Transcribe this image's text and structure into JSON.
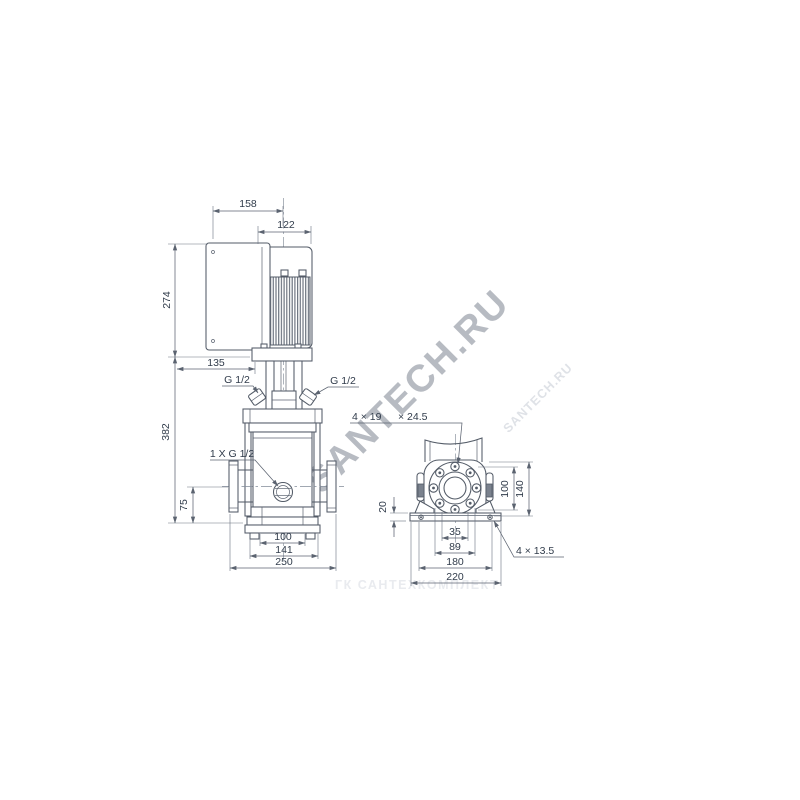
{
  "watermarks": {
    "main": "SANTECH.RU",
    "small": "SANTECH.RU",
    "bottom": "ГК САНТЕХКОМПЛЕКТ"
  },
  "front_view": {
    "dim_158": "158",
    "dim_122": "122",
    "dim_274": "274",
    "dim_135": "135",
    "port_left_label": "G 1/2",
    "port_right_label": "G 1/2",
    "dim_382": "382",
    "drain_label": "1 X G 1/2",
    "dim_75": "75",
    "dim_100": "100",
    "dim_141": "141",
    "dim_250": "250"
  },
  "side_view": {
    "flange_hole_count": "4 × 19",
    "flange_hole_depth": "× 24.5",
    "dim_100": "100",
    "dim_140": "140",
    "dim_20": "20",
    "dim_35": "35",
    "dim_89": "89",
    "dim_180": "180",
    "dim_220": "220",
    "base_hole_label": "4 × 13.5"
  },
  "colors": {
    "line": "#535b67",
    "text": "#313c4b",
    "watermark_main": "#b7bbc2",
    "watermark_faint": "#e9ebef"
  }
}
